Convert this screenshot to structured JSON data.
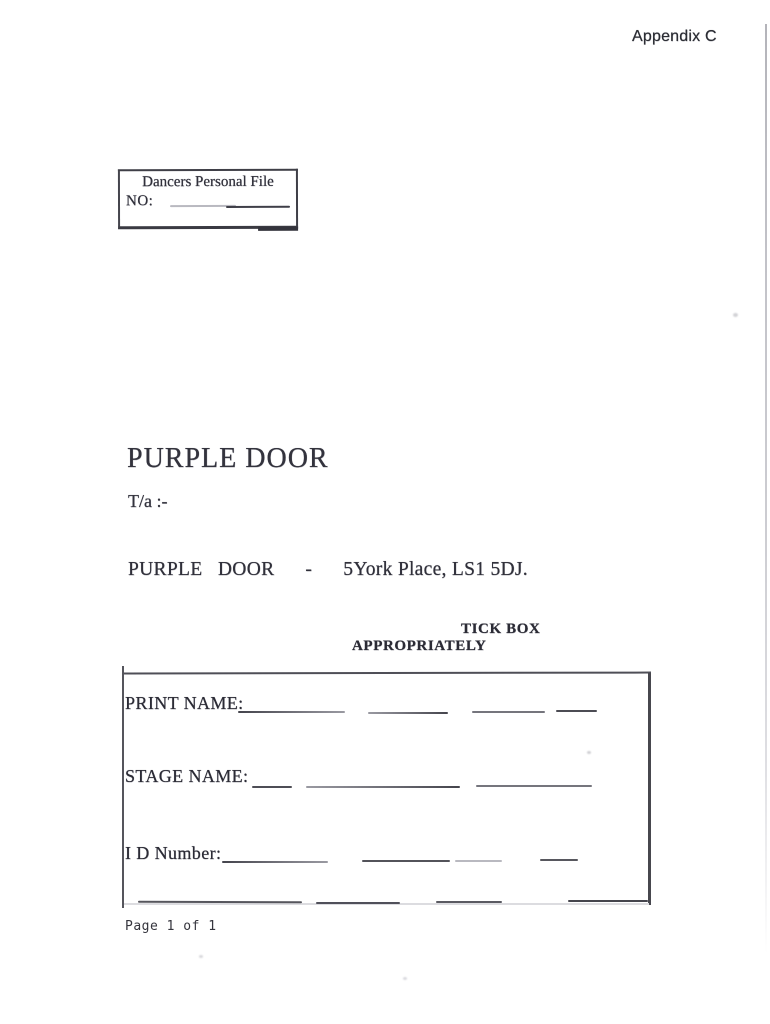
{
  "doc": {
    "appendix": "Appendix C",
    "file_box": {
      "title": "Dancers Personal File",
      "no_label": "NO:"
    },
    "title": "PURPLE DOOR",
    "trading_as": "T/a :-",
    "address": "PURPLE   DOOR      -      5York Place, LS1 5DJ.",
    "instruction": {
      "line1": "TICK BOX",
      "line2": "APPROPRIATELY"
    },
    "form": {
      "print_name": "PRINT NAME:",
      "stage_name": "STAGE NAME:",
      "id_number": "I D Number:"
    },
    "footer": "Page 1 of 1"
  },
  "colors": {
    "ink": "#2e2e38",
    "paper": "#ffffff",
    "scan_artifact": "#c2c2c8"
  }
}
